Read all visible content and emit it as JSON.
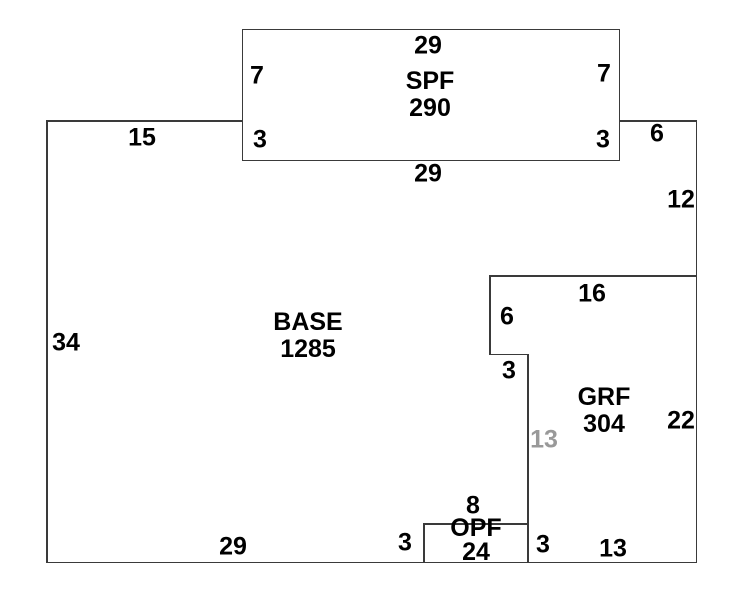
{
  "colors": {
    "bg-color": "#ffffff",
    "line-color": "#3a3a3a",
    "text-color": "#000000",
    "shared-dim-color": "#999999"
  },
  "regions": {
    "spf": {
      "name": "SPF",
      "area": "290"
    },
    "base": {
      "name": "BASE",
      "area": "1285"
    },
    "grf": {
      "name": "GRF",
      "area": "304"
    },
    "opf": {
      "name": "OPF",
      "area": "24"
    }
  },
  "dimensions": {
    "spf_top_width": "29",
    "spf_left_upper": "7",
    "spf_right_upper": "7",
    "spf_left_lower": "3",
    "spf_right_lower": "3",
    "spf_bottom_width": "29",
    "base_top_left": "15",
    "base_top_right": "6",
    "right_wall_upper": "12",
    "left_wall": "34",
    "grf_top": "16",
    "grf_left_upper": "6",
    "grf_step": "3",
    "grf_inner_shared": "13",
    "grf_right_wall": "22",
    "opf_top": "8",
    "opf_left": "3",
    "opf_right": "3",
    "bottom_right": "13",
    "bottom_left": "29"
  }
}
